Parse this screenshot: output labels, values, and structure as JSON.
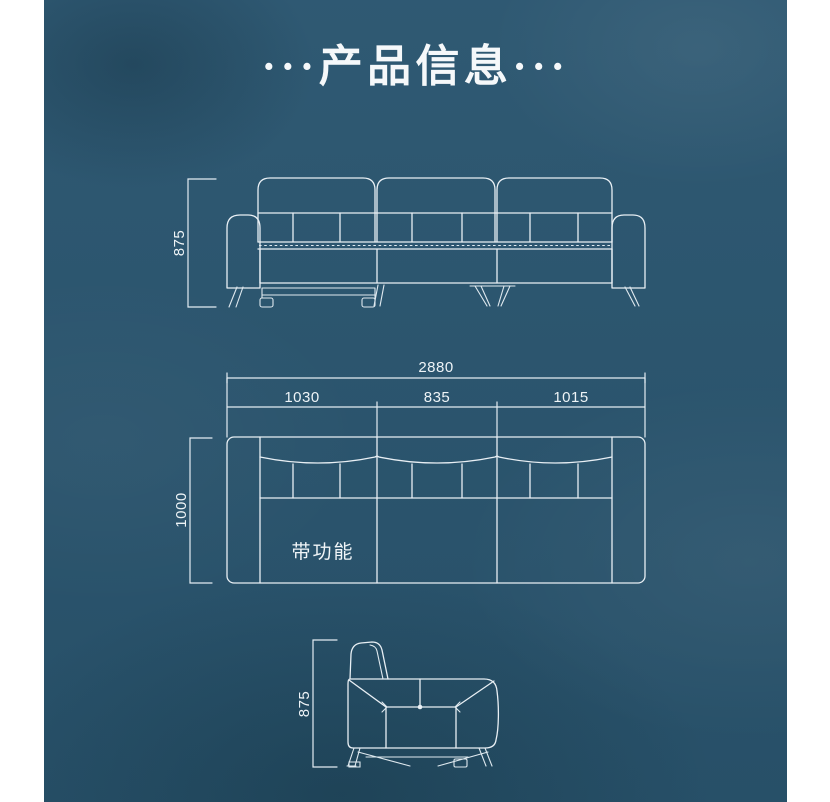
{
  "title": {
    "text": "···产品信息···"
  },
  "colors": {
    "background": "#2b5670",
    "line": "#e8eff4",
    "label_text": "#eef4f7",
    "margin": "#ffffff"
  },
  "views": {
    "front": {
      "height_label": "875"
    },
    "plan": {
      "total_width_label": "2880",
      "segment_left_label": "1030",
      "segment_middle_label": "835",
      "segment_right_label": "1015",
      "depth_label": "1000",
      "feature_label": "带功能"
    },
    "side": {
      "height_label": "875"
    }
  }
}
